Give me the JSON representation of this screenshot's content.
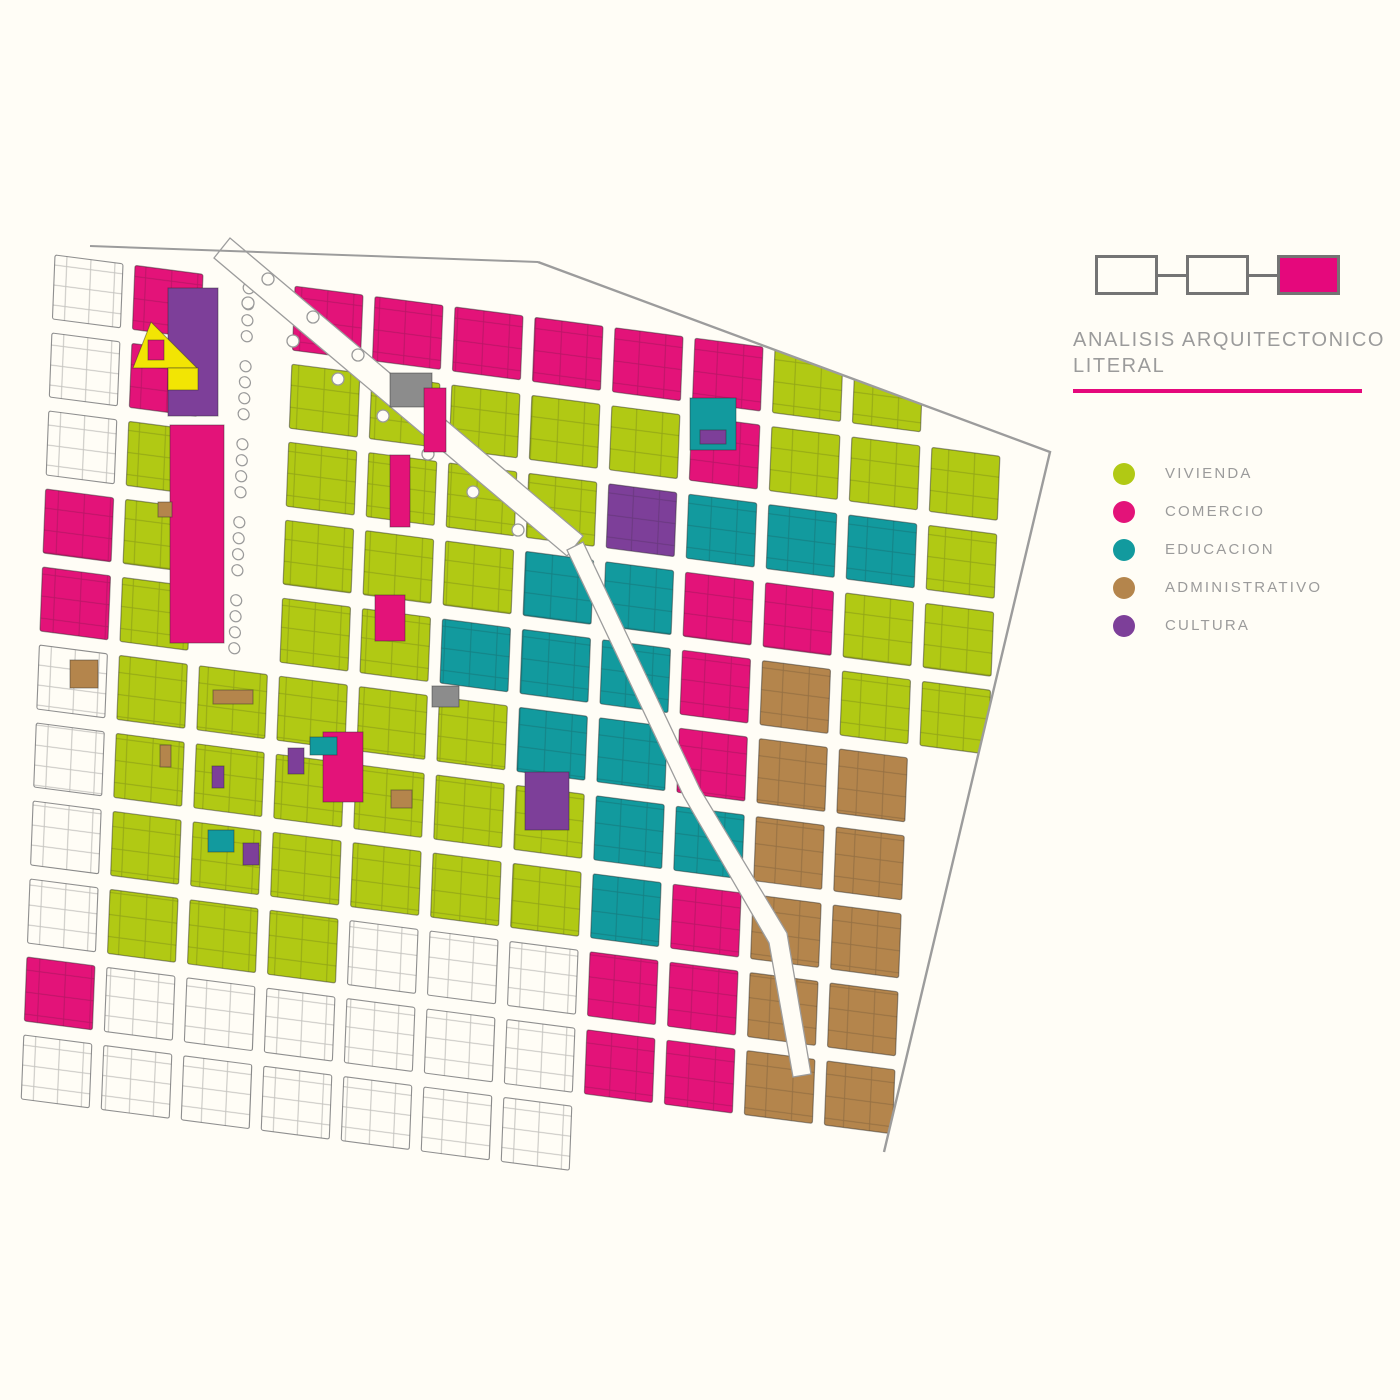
{
  "page": {
    "background": "#fffdf6"
  },
  "header": {
    "diagram": {
      "box_count": 3,
      "boxes": [
        {
          "filled": false
        },
        {
          "filled": false
        },
        {
          "filled": true
        }
      ],
      "box_border_color": "#747474",
      "filled_color": "#e5087c"
    },
    "title_line1": "ANALISIS  ARQUITECTONICO",
    "title_line2": "LITERAL",
    "title_color": "#9b9b9b",
    "underline_color": "#e5087c"
  },
  "legend": {
    "label_color": "#9b9b9b",
    "items": [
      {
        "label": "VIVIENDA",
        "color": "#b1c914",
        "code": "G"
      },
      {
        "label": "COMERCIO",
        "color": "#e31379",
        "code": "P"
      },
      {
        "label": "EDUCACION",
        "color": "#129a9e",
        "code": "T"
      },
      {
        "label": "ADMINISTRATIVO",
        "color": "#b4854c",
        "code": "B"
      },
      {
        "label": "CULTURA",
        "color": "#7d3f99",
        "code": "C"
      }
    ]
  },
  "map": {
    "land_use_codes": {
      "G": "vivienda",
      "P": "comercio",
      "T": "educacion",
      "B": "administrativo",
      "C": "cultura",
      "Y": "amarillo-destacado",
      "A": "gris-equipamiento",
      "X": "fuera-de-ambito",
      "K": "parque",
      ".": "vacio"
    },
    "palette": {
      "G": "#b1c914",
      "P": "#e31379",
      "T": "#129a9e",
      "B": "#b4854c",
      "C": "#7d3f99",
      "Y": "#f2e504",
      "A": "#8c8c8c",
      "X": "#fffdf6"
    },
    "strokes": {
      "colored": "rgba(40,40,40,0.45)",
      "uncolored": "#8f8f8f",
      "street": "#9c9c9c",
      "tree": "#9a9a9a"
    },
    "grid": {
      "origin": [
        55,
        255
      ],
      "pitch": [
        80,
        78
      ],
      "cell": [
        68,
        64
      ],
      "shear": [
        0.13,
        -0.04
      ],
      "rows": [
        "XPKPPPPPPGG..",
        "XPKGGGGGPGGG.",
        "XGKGGGGCTTTG.",
        "PGKGGGTTPPGG.",
        "PGKGGTTTPBGG.",
        "XGGGGGTTPBB..",
        "XGGGGGGTTBB..",
        "XGGGGGGTPBB..",
        "XGGGXXXPPBB..",
        "PXXXXXXPPBB..",
        "XXXXXXX......"
      ]
    },
    "specials": [
      {
        "c": "C",
        "r": [
          168,
          288,
          50,
          128
        ]
      },
      {
        "c": "P",
        "r": [
          170,
          425,
          54,
          218
        ]
      },
      {
        "c": "Y",
        "pts": "151,322 197,368 133,368"
      },
      {
        "c": "Y",
        "r": [
          168,
          368,
          30,
          22
        ]
      },
      {
        "c": "P",
        "r": [
          148,
          340,
          16,
          20
        ]
      },
      {
        "c": "A",
        "r": [
          390,
          373,
          42,
          34
        ]
      },
      {
        "c": "T",
        "r": [
          690,
          398,
          46,
          52
        ]
      },
      {
        "c": "C",
        "r": [
          700,
          430,
          26,
          14
        ]
      },
      {
        "c": "P",
        "r": [
          424,
          388,
          22,
          64
        ]
      },
      {
        "c": "P",
        "r": [
          390,
          455,
          20,
          72
        ]
      },
      {
        "c": "P",
        "r": [
          375,
          595,
          30,
          46
        ]
      },
      {
        "c": "P",
        "r": [
          323,
          732,
          40,
          70
        ]
      },
      {
        "c": "T",
        "r": [
          310,
          737,
          27,
          18
        ]
      },
      {
        "c": "T",
        "r": [
          208,
          830,
          26,
          22
        ]
      },
      {
        "c": "C",
        "r": [
          288,
          748,
          16,
          26
        ]
      },
      {
        "c": "C",
        "r": [
          212,
          766,
          12,
          22
        ]
      },
      {
        "c": "C",
        "r": [
          243,
          843,
          16,
          22
        ]
      },
      {
        "c": "C",
        "r": [
          525,
          772,
          44,
          58
        ]
      },
      {
        "c": "B",
        "r": [
          70,
          660,
          28,
          28
        ]
      },
      {
        "c": "B",
        "r": [
          213,
          690,
          40,
          14
        ]
      },
      {
        "c": "B",
        "r": [
          158,
          502,
          14,
          15
        ]
      },
      {
        "c": "B",
        "r": [
          160,
          745,
          11,
          22
        ]
      },
      {
        "c": "B",
        "r": [
          391,
          790,
          21,
          18
        ]
      },
      {
        "c": "A",
        "r": [
          432,
          686,
          27,
          21
        ]
      }
    ],
    "avenues": [
      "214,258 230,238 583,536 567,556",
      "567,550 684,797 769,943 793,1077 811,1074 787,933 700,789 583,542"
    ],
    "trees_avenue": [
      [
        248,
        303
      ],
      [
        293,
        341
      ],
      [
        338,
        379
      ],
      [
        383,
        416
      ],
      [
        428,
        454
      ],
      [
        473,
        492
      ],
      [
        518,
        530
      ],
      [
        268,
        279
      ],
      [
        313,
        317
      ],
      [
        358,
        355
      ],
      [
        403,
        392
      ]
    ],
    "covers": [
      "516,170 1120,170 1120,452 1050,452 538,262",
      "1050,452 1120,452 1120,1220 846,1220 884,1152"
    ],
    "boundary_path": "M538,262 L1050,452 L884,1152",
    "top_edge_path": "M90,246 L538,262"
  }
}
